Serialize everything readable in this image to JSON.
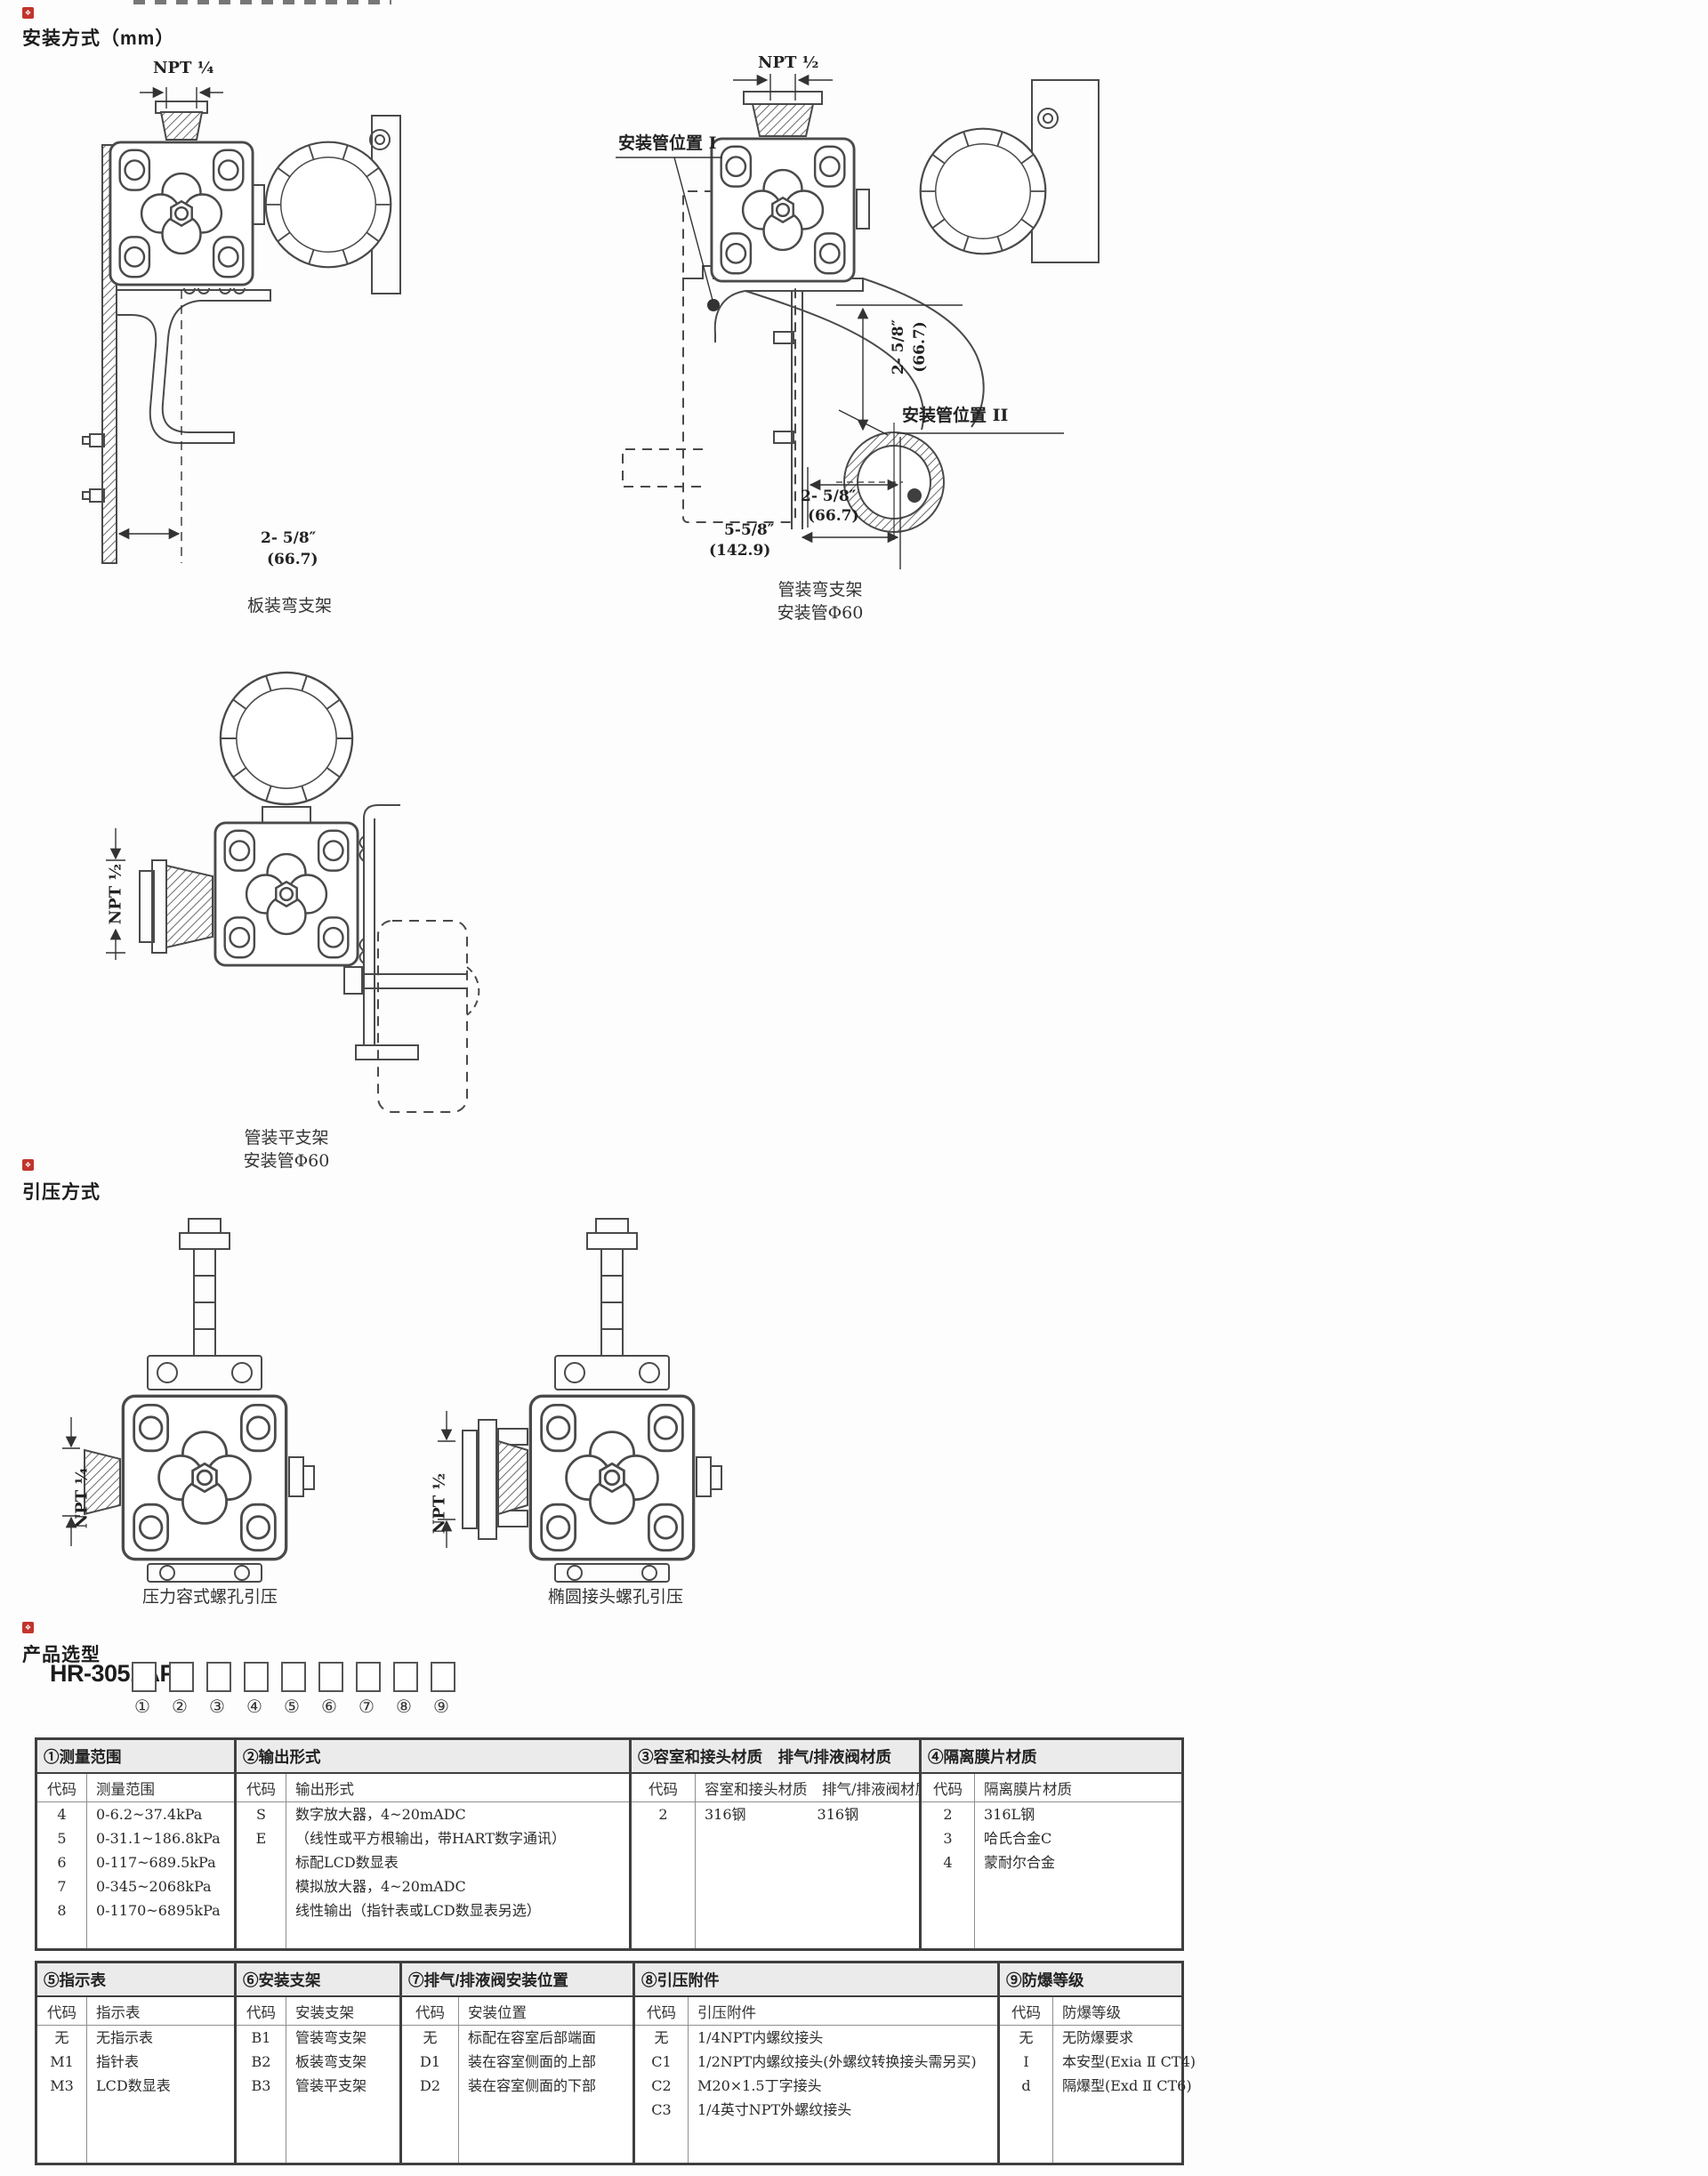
{
  "mounting": {
    "marker": "❖",
    "title": "安装方式（mm）",
    "plate_bracket": {
      "npt_label": "NPT ¼",
      "dim_width": "2- 5/8″",
      "dim_width_mm": "(66.7)",
      "caption": "板装弯支架"
    },
    "pipe_bent_bracket": {
      "npt_label": "NPT ½",
      "pipe_pos1_label": "安装管位置 I",
      "pipe_pos2_label": "安装管位置 II",
      "dim_height": "2- 5/8″",
      "dim_height_mm": "(66.7)",
      "dim_width1": "2- 5/8″",
      "dim_width1_mm": "(66.7)",
      "dim_width2": "5-5/8″",
      "dim_width2_mm": "(142.9)",
      "caption_line1": "管装弯支架",
      "caption_line2": "安装管Φ60"
    },
    "pipe_flat_bracket": {
      "npt_label": "NPT ½",
      "caption_line1": "管装平支架",
      "caption_line2": "安装管Φ60"
    }
  },
  "pressure_intro": {
    "marker": "❖",
    "title": "引压方式",
    "chamber_tap": {
      "npt_label": "NPT ¼",
      "caption": "压力容式螺孔引压"
    },
    "oval_tap": {
      "npt_label": "NPT ½",
      "caption": "椭圆接头螺孔引压"
    }
  },
  "selection": {
    "marker": "❖",
    "title": "产品选型",
    "model_prefix": "HR-3051AP-",
    "position_labels": [
      "①",
      "②",
      "③",
      "④",
      "⑤",
      "⑥",
      "⑦",
      "⑧",
      "⑨"
    ],
    "band1": [
      {
        "title": "①测量范围",
        "code_header": "代码",
        "value_header": "测量范围",
        "rows": [
          {
            "code": "4",
            "value": "0-6.2~37.4kPa"
          },
          {
            "code": "5",
            "value": "0-31.1~186.8kPa"
          },
          {
            "code": "6",
            "value": "0-117~689.5kPa"
          },
          {
            "code": "7",
            "value": "0-345~2068kPa"
          },
          {
            "code": "8",
            "value": "0-1170~6895kPa"
          }
        ]
      },
      {
        "title": "②输出形式",
        "code_header": "代码",
        "value_header": "输出形式",
        "rows": [
          {
            "code": "S",
            "value": "数字放大器，4~20mADC"
          },
          {
            "code": "",
            "value": "（线性或平方根输出，带HART数字通讯）"
          },
          {
            "code": "",
            "value": "标配LCD数显表"
          },
          {
            "code": "E",
            "value": "模拟放大器，4~20mADC"
          },
          {
            "code": "",
            "value": "线性输出（指针表或LCD数显表另选）"
          }
        ]
      },
      {
        "title": "③容室和接头材质　排气/排液阀材质",
        "code_header": "代码",
        "value_header": "容室和接头材质　排气/排液阀材质",
        "rows": [
          {
            "code": "2",
            "value": "316钢　　　　　316钢"
          }
        ]
      },
      {
        "title": "④隔离膜片材质",
        "code_header": "代码",
        "value_header": "隔离膜片材质",
        "rows": [
          {
            "code": "2",
            "value": "316L钢"
          },
          {
            "code": "3",
            "value": "哈氏合金C"
          },
          {
            "code": "4",
            "value": "蒙耐尔合金"
          }
        ]
      }
    ],
    "band2": [
      {
        "title": "⑤指示表",
        "code_header": "代码",
        "value_header": "指示表",
        "rows": [
          {
            "code": "无",
            "value": "无指示表"
          },
          {
            "code": "M1",
            "value": "指针表"
          },
          {
            "code": "M3",
            "value": "LCD数显表"
          }
        ]
      },
      {
        "title": "⑥安装支架",
        "code_header": "代码",
        "value_header": "安装支架",
        "rows": [
          {
            "code": "B1",
            "value": "管装弯支架"
          },
          {
            "code": "B2",
            "value": "板装弯支架"
          },
          {
            "code": "B3",
            "value": "管装平支架"
          }
        ]
      },
      {
        "title": "⑦排气/排液阀安装位置",
        "code_header": "代码",
        "value_header": "安装位置",
        "rows": [
          {
            "code": "无",
            "value": "标配在容室后部端面"
          },
          {
            "code": "D1",
            "value": "装在容室侧面的上部"
          },
          {
            "code": "D2",
            "value": "装在容室侧面的下部"
          }
        ]
      },
      {
        "title": "⑧引压附件",
        "code_header": "代码",
        "value_header": "引压附件",
        "rows": [
          {
            "code": "无",
            "value": "1/4NPT内螺纹接头"
          },
          {
            "code": "C1",
            "value": "1/2NPT内螺纹接头(外螺纹转换接头需另买)"
          },
          {
            "code": "C2",
            "value": "M20×1.5丁字接头"
          },
          {
            "code": "C3",
            "value": "1/4英寸NPT外螺纹接头"
          }
        ]
      },
      {
        "title": "⑨防爆等级",
        "code_header": "代码",
        "value_header": "防爆等级",
        "rows": [
          {
            "code": "无",
            "value": "无防爆要求"
          },
          {
            "code": "I",
            "value": "本安型(Exia Ⅱ CT4)"
          },
          {
            "code": "d",
            "value": "隔爆型(Exd Ⅱ CT6)"
          }
        ]
      }
    ]
  }
}
